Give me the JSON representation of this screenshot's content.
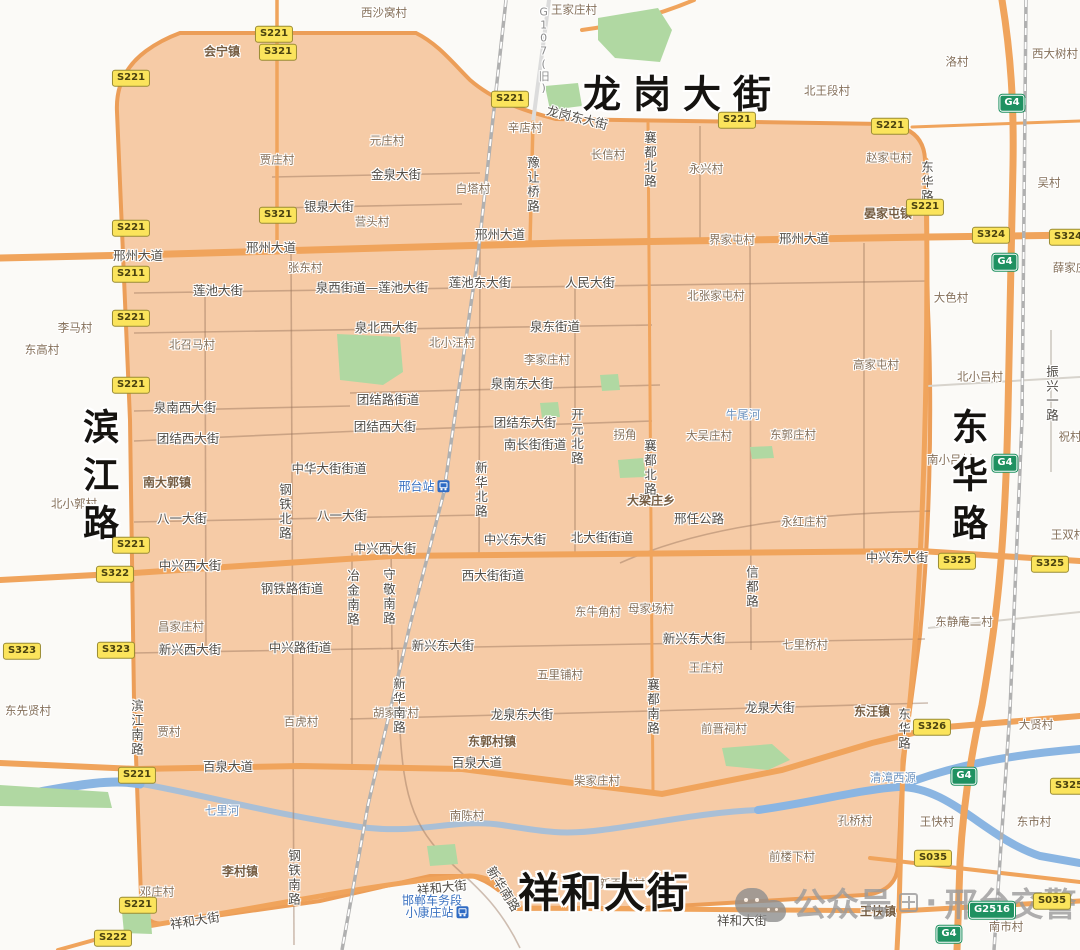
{
  "colors": {
    "bg": "#fbfaf7",
    "zone_fill": "#f6cba6",
    "zone_border": "#ec9e58",
    "road_major": "#f0a45c",
    "green": "#b0d8a2",
    "water": "#8ab5e2",
    "river_gray": "#a9bfd6",
    "railway": "#b0b0b0",
    "village_text": "#85705a",
    "town_text": "#755c41",
    "street_text": "#514d47",
    "water_text": "#6d92bd",
    "station_text": "#3b72c0",
    "badge_yellow_bg": "#fbe45c",
    "badge_green_bg": "#1f9161",
    "watermark_gray": "#9b9b9b"
  },
  "map": {
    "big_labels": [
      {
        "text": "龙岗大街",
        "x": 683,
        "y": 95,
        "size": 38,
        "ls": 12
      },
      {
        "text": "滨江路",
        "x": 97,
        "y": 480,
        "size": 36,
        "ls": 12,
        "vertical": true
      },
      {
        "text": "东华路",
        "x": 966,
        "y": 480,
        "size": 36,
        "ls": 12,
        "vertical": true
      },
      {
        "text": "祥和大街",
        "x": 604,
        "y": 894,
        "size": 41,
        "ls": 2
      }
    ],
    "towns": [
      {
        "text": "会宁镇",
        "x": 222,
        "y": 52
      },
      {
        "text": "晏家屯镇",
        "x": 888,
        "y": 214
      },
      {
        "text": "南大郭镇",
        "x": 167,
        "y": 483
      },
      {
        "text": "大梁庄乡",
        "x": 651,
        "y": 501
      },
      {
        "text": "东汪镇",
        "x": 872,
        "y": 712
      },
      {
        "text": "李村镇",
        "x": 240,
        "y": 872
      },
      {
        "text": "东郭村镇",
        "x": 492,
        "y": 742
      },
      {
        "text": "王快镇",
        "x": 878,
        "y": 912
      }
    ],
    "villages": [
      {
        "text": "西沙窝村",
        "x": 384,
        "y": 13
      },
      {
        "text": "王家庄村",
        "x": 574,
        "y": 10
      },
      {
        "text": "北王段村",
        "x": 827,
        "y": 91
      },
      {
        "text": "洛村",
        "x": 957,
        "y": 62
      },
      {
        "text": "西大树村",
        "x": 1055,
        "y": 54
      },
      {
        "text": "吴村",
        "x": 1049,
        "y": 183
      },
      {
        "text": "辛店村",
        "x": 525,
        "y": 128
      },
      {
        "text": "元庄村",
        "x": 387,
        "y": 141
      },
      {
        "text": "贾庄村",
        "x": 277,
        "y": 160
      },
      {
        "text": "长信村",
        "x": 608,
        "y": 155
      },
      {
        "text": "永兴村",
        "x": 706,
        "y": 169
      },
      {
        "text": "白塔村",
        "x": 473,
        "y": 189
      },
      {
        "text": "赵家屯村",
        "x": 889,
        "y": 158
      },
      {
        "text": "营头村",
        "x": 372,
        "y": 222
      },
      {
        "text": "张东村",
        "x": 305,
        "y": 268
      },
      {
        "text": "界家屯村",
        "x": 732,
        "y": 240
      },
      {
        "text": "北张家屯村",
        "x": 716,
        "y": 296
      },
      {
        "text": "大色村",
        "x": 951,
        "y": 298
      },
      {
        "text": "薛家庄",
        "x": 1070,
        "y": 268
      },
      {
        "text": "李马村",
        "x": 75,
        "y": 328
      },
      {
        "text": "东高村",
        "x": 42,
        "y": 350
      },
      {
        "text": "北召马村",
        "x": 192,
        "y": 345
      },
      {
        "text": "北小汪村",
        "x": 452,
        "y": 343
      },
      {
        "text": "李家庄村",
        "x": 547,
        "y": 360
      },
      {
        "text": "高家屯村",
        "x": 876,
        "y": 365
      },
      {
        "text": "北小吕村",
        "x": 980,
        "y": 377
      },
      {
        "text": "南小吕村",
        "x": 950,
        "y": 460
      },
      {
        "text": "拐角",
        "x": 625,
        "y": 435
      },
      {
        "text": "大吴庄村",
        "x": 709,
        "y": 436
      },
      {
        "text": "东郭庄村",
        "x": 793,
        "y": 435
      },
      {
        "text": "祝村",
        "x": 1070,
        "y": 437
      },
      {
        "text": "北小郭村",
        "x": 74,
        "y": 504
      },
      {
        "text": "永红庄村",
        "x": 804,
        "y": 522
      },
      {
        "text": "王双村",
        "x": 1068,
        "y": 535
      },
      {
        "text": "东静庵二村",
        "x": 964,
        "y": 622
      },
      {
        "text": "昌家庄村",
        "x": 181,
        "y": 627
      },
      {
        "text": "东牛角村",
        "x": 598,
        "y": 612
      },
      {
        "text": "母家场村",
        "x": 651,
        "y": 609
      },
      {
        "text": "七里桥村",
        "x": 805,
        "y": 645
      },
      {
        "text": "王庄村",
        "x": 706,
        "y": 668
      },
      {
        "text": "五里铺村",
        "x": 560,
        "y": 675
      },
      {
        "text": "东先贤村",
        "x": 28,
        "y": 711
      },
      {
        "text": "贾村",
        "x": 169,
        "y": 732
      },
      {
        "text": "百虎村",
        "x": 301,
        "y": 722
      },
      {
        "text": "胡家营村",
        "x": 396,
        "y": 713
      },
      {
        "text": "前晋祠村",
        "x": 724,
        "y": 729
      },
      {
        "text": "大贤村",
        "x": 1036,
        "y": 725
      },
      {
        "text": "柴家庄村",
        "x": 597,
        "y": 781
      },
      {
        "text": "南陈村",
        "x": 467,
        "y": 816
      },
      {
        "text": "孔桥村",
        "x": 855,
        "y": 821
      },
      {
        "text": "王快村",
        "x": 937,
        "y": 822
      },
      {
        "text": "东市村",
        "x": 1034,
        "y": 822
      },
      {
        "text": "前楼下村",
        "x": 792,
        "y": 857
      },
      {
        "text": "邓庄村",
        "x": 157,
        "y": 892
      },
      {
        "text": "南市村",
        "x": 1006,
        "y": 927
      },
      {
        "text": "新百泉村",
        "x": 622,
        "y": 884
      }
    ],
    "streets": [
      {
        "text": "龙岗东大街",
        "x": 577,
        "y": 118,
        "rot": 14
      },
      {
        "text": "邢州大道",
        "x": 138,
        "y": 256
      },
      {
        "text": "邢州大道",
        "x": 271,
        "y": 248
      },
      {
        "text": "邢州大道",
        "x": 500,
        "y": 235
      },
      {
        "text": "邢州大道",
        "x": 804,
        "y": 239
      },
      {
        "text": "金泉大街",
        "x": 396,
        "y": 175
      },
      {
        "text": "银泉大街",
        "x": 329,
        "y": 207
      },
      {
        "text": "莲池大街",
        "x": 218,
        "y": 291
      },
      {
        "text": "泉西街道—莲池大街",
        "x": 372,
        "y": 288
      },
      {
        "text": "莲池东大街",
        "x": 480,
        "y": 283
      },
      {
        "text": "人民大街",
        "x": 590,
        "y": 283
      },
      {
        "text": "泉北西大街",
        "x": 386,
        "y": 328
      },
      {
        "text": "泉东街道",
        "x": 555,
        "y": 327
      },
      {
        "text": "泉南西大街",
        "x": 185,
        "y": 408
      },
      {
        "text": "泉南东大街",
        "x": 522,
        "y": 384
      },
      {
        "text": "团结路街道",
        "x": 388,
        "y": 400
      },
      {
        "text": "团结西大街",
        "x": 188,
        "y": 439
      },
      {
        "text": "团结西大街",
        "x": 385,
        "y": 427
      },
      {
        "text": "团结东大街",
        "x": 525,
        "y": 423
      },
      {
        "text": "南长街街道",
        "x": 535,
        "y": 445
      },
      {
        "text": "中华大街街道",
        "x": 329,
        "y": 469
      },
      {
        "text": "八一大街",
        "x": 182,
        "y": 519
      },
      {
        "text": "八一大街",
        "x": 342,
        "y": 516
      },
      {
        "text": "邢任公路",
        "x": 699,
        "y": 519
      },
      {
        "text": "中兴西大街",
        "x": 190,
        "y": 566
      },
      {
        "text": "中兴西大街",
        "x": 385,
        "y": 549
      },
      {
        "text": "中兴东大街",
        "x": 515,
        "y": 540
      },
      {
        "text": "北大街街道",
        "x": 602,
        "y": 538
      },
      {
        "text": "中兴东大街",
        "x": 897,
        "y": 558
      },
      {
        "text": "西大街街道",
        "x": 493,
        "y": 576
      },
      {
        "text": "钢铁路街道",
        "x": 292,
        "y": 589
      },
      {
        "text": "新兴西大街",
        "x": 190,
        "y": 650
      },
      {
        "text": "中兴路街道",
        "x": 300,
        "y": 648
      },
      {
        "text": "新兴东大街",
        "x": 443,
        "y": 646
      },
      {
        "text": "新兴东大街",
        "x": 694,
        "y": 639
      },
      {
        "text": "龙泉东大街",
        "x": 522,
        "y": 715
      },
      {
        "text": "龙泉大街",
        "x": 770,
        "y": 708
      },
      {
        "text": "百泉大道",
        "x": 228,
        "y": 767
      },
      {
        "text": "百泉大道",
        "x": 477,
        "y": 763
      },
      {
        "text": "新华南路",
        "x": 503,
        "y": 889,
        "rot": 58
      },
      {
        "text": "祥和大街",
        "x": 195,
        "y": 921,
        "rot": -9
      },
      {
        "text": "祥和大街",
        "x": 442,
        "y": 888,
        "rot": -6
      },
      {
        "text": "祥和大街",
        "x": 742,
        "y": 921
      }
    ],
    "vertical_streets": [
      {
        "text": "G107(旧)",
        "x": 543,
        "y": 50,
        "cls": "label-g107"
      },
      {
        "text": "豫让桥路",
        "x": 532,
        "y": 185
      },
      {
        "text": "襄都北路",
        "x": 649,
        "y": 160
      },
      {
        "text": "襄都北路",
        "x": 649,
        "y": 468
      },
      {
        "text": "东华路",
        "x": 926,
        "y": 182
      },
      {
        "text": "振兴一路",
        "x": 1051,
        "y": 394
      },
      {
        "text": "开元北路",
        "x": 576,
        "y": 437
      },
      {
        "text": "新华北路",
        "x": 480,
        "y": 490
      },
      {
        "text": "钢铁北路",
        "x": 284,
        "y": 512
      },
      {
        "text": "守敬南路",
        "x": 388,
        "y": 597
      },
      {
        "text": "冶金南路",
        "x": 352,
        "y": 598
      },
      {
        "text": "信都路",
        "x": 751,
        "y": 587
      },
      {
        "text": "襄都南路",
        "x": 652,
        "y": 707
      },
      {
        "text": "新华南路",
        "x": 398,
        "y": 706
      },
      {
        "text": "滨江南路",
        "x": 136,
        "y": 728
      },
      {
        "text": "钢铁南路",
        "x": 293,
        "y": 878
      },
      {
        "text": "东华路",
        "x": 903,
        "y": 729
      }
    ],
    "water_labels": [
      {
        "text": "牛尾河",
        "x": 743,
        "y": 415
      },
      {
        "text": "七里河",
        "x": 222,
        "y": 811
      },
      {
        "text": "清漳西源",
        "x": 893,
        "y": 778
      }
    ],
    "stations": [
      {
        "text": "邢台站",
        "x": 424,
        "y": 487,
        "icon": "right"
      },
      {
        "text": "邯郸车务段",
        "x": 432,
        "y": 901
      },
      {
        "text": "小康庄站",
        "x": 437,
        "y": 913,
        "icon": "right"
      }
    ],
    "badges": [
      {
        "code": "S221",
        "type": "provincial",
        "x": 274,
        "y": 34
      },
      {
        "code": "S321",
        "type": "provincial",
        "x": 278,
        "y": 52
      },
      {
        "code": "S221",
        "type": "provincial",
        "x": 131,
        "y": 78
      },
      {
        "code": "S221",
        "type": "provincial",
        "x": 510,
        "y": 99
      },
      {
        "code": "S221",
        "type": "provincial",
        "x": 737,
        "y": 120
      },
      {
        "code": "S221",
        "type": "provincial",
        "x": 890,
        "y": 126
      },
      {
        "code": "S221",
        "type": "provincial",
        "x": 925,
        "y": 207
      },
      {
        "code": "S321",
        "type": "provincial",
        "x": 278,
        "y": 215
      },
      {
        "code": "S221",
        "type": "provincial",
        "x": 131,
        "y": 228
      },
      {
        "code": "S211",
        "type": "provincial",
        "x": 131,
        "y": 274
      },
      {
        "code": "S221",
        "type": "provincial",
        "x": 131,
        "y": 318
      },
      {
        "code": "S221",
        "type": "provincial",
        "x": 131,
        "y": 385
      },
      {
        "code": "S221",
        "type": "provincial",
        "x": 131,
        "y": 545
      },
      {
        "code": "S322",
        "type": "provincial",
        "x": 115,
        "y": 574
      },
      {
        "code": "S323",
        "type": "provincial",
        "x": 22,
        "y": 651
      },
      {
        "code": "S323",
        "type": "provincial",
        "x": 116,
        "y": 650
      },
      {
        "code": "S221",
        "type": "provincial",
        "x": 137,
        "y": 775
      },
      {
        "code": "S221",
        "type": "provincial",
        "x": 138,
        "y": 905
      },
      {
        "code": "S222",
        "type": "provincial",
        "x": 113,
        "y": 938
      },
      {
        "code": "S324",
        "type": "provincial",
        "x": 991,
        "y": 235
      },
      {
        "code": "S324",
        "type": "provincial",
        "x": 1068,
        "y": 237
      },
      {
        "code": "G4",
        "type": "national",
        "x": 1012,
        "y": 103
      },
      {
        "code": "G4",
        "type": "national",
        "x": 1005,
        "y": 262
      },
      {
        "code": "G4",
        "type": "national",
        "x": 1005,
        "y": 463
      },
      {
        "code": "S325",
        "type": "provincial",
        "x": 957,
        "y": 561
      },
      {
        "code": "S325",
        "type": "provincial",
        "x": 1050,
        "y": 564
      },
      {
        "code": "S326",
        "type": "provincial",
        "x": 932,
        "y": 727
      },
      {
        "code": "G4",
        "type": "national",
        "x": 964,
        "y": 776
      },
      {
        "code": "S325",
        "type": "provincial",
        "x": 1069,
        "y": 786
      },
      {
        "code": "S035",
        "type": "provincial",
        "x": 933,
        "y": 858
      },
      {
        "code": "G2516",
        "type": "national",
        "x": 992,
        "y": 910
      },
      {
        "code": "S035",
        "type": "provincial",
        "x": 1052,
        "y": 901
      },
      {
        "code": "G4",
        "type": "national",
        "x": 949,
        "y": 934
      }
    ],
    "watermark": {
      "text1": "公众号",
      "dot": "·",
      "text2": "邢台交警"
    }
  }
}
